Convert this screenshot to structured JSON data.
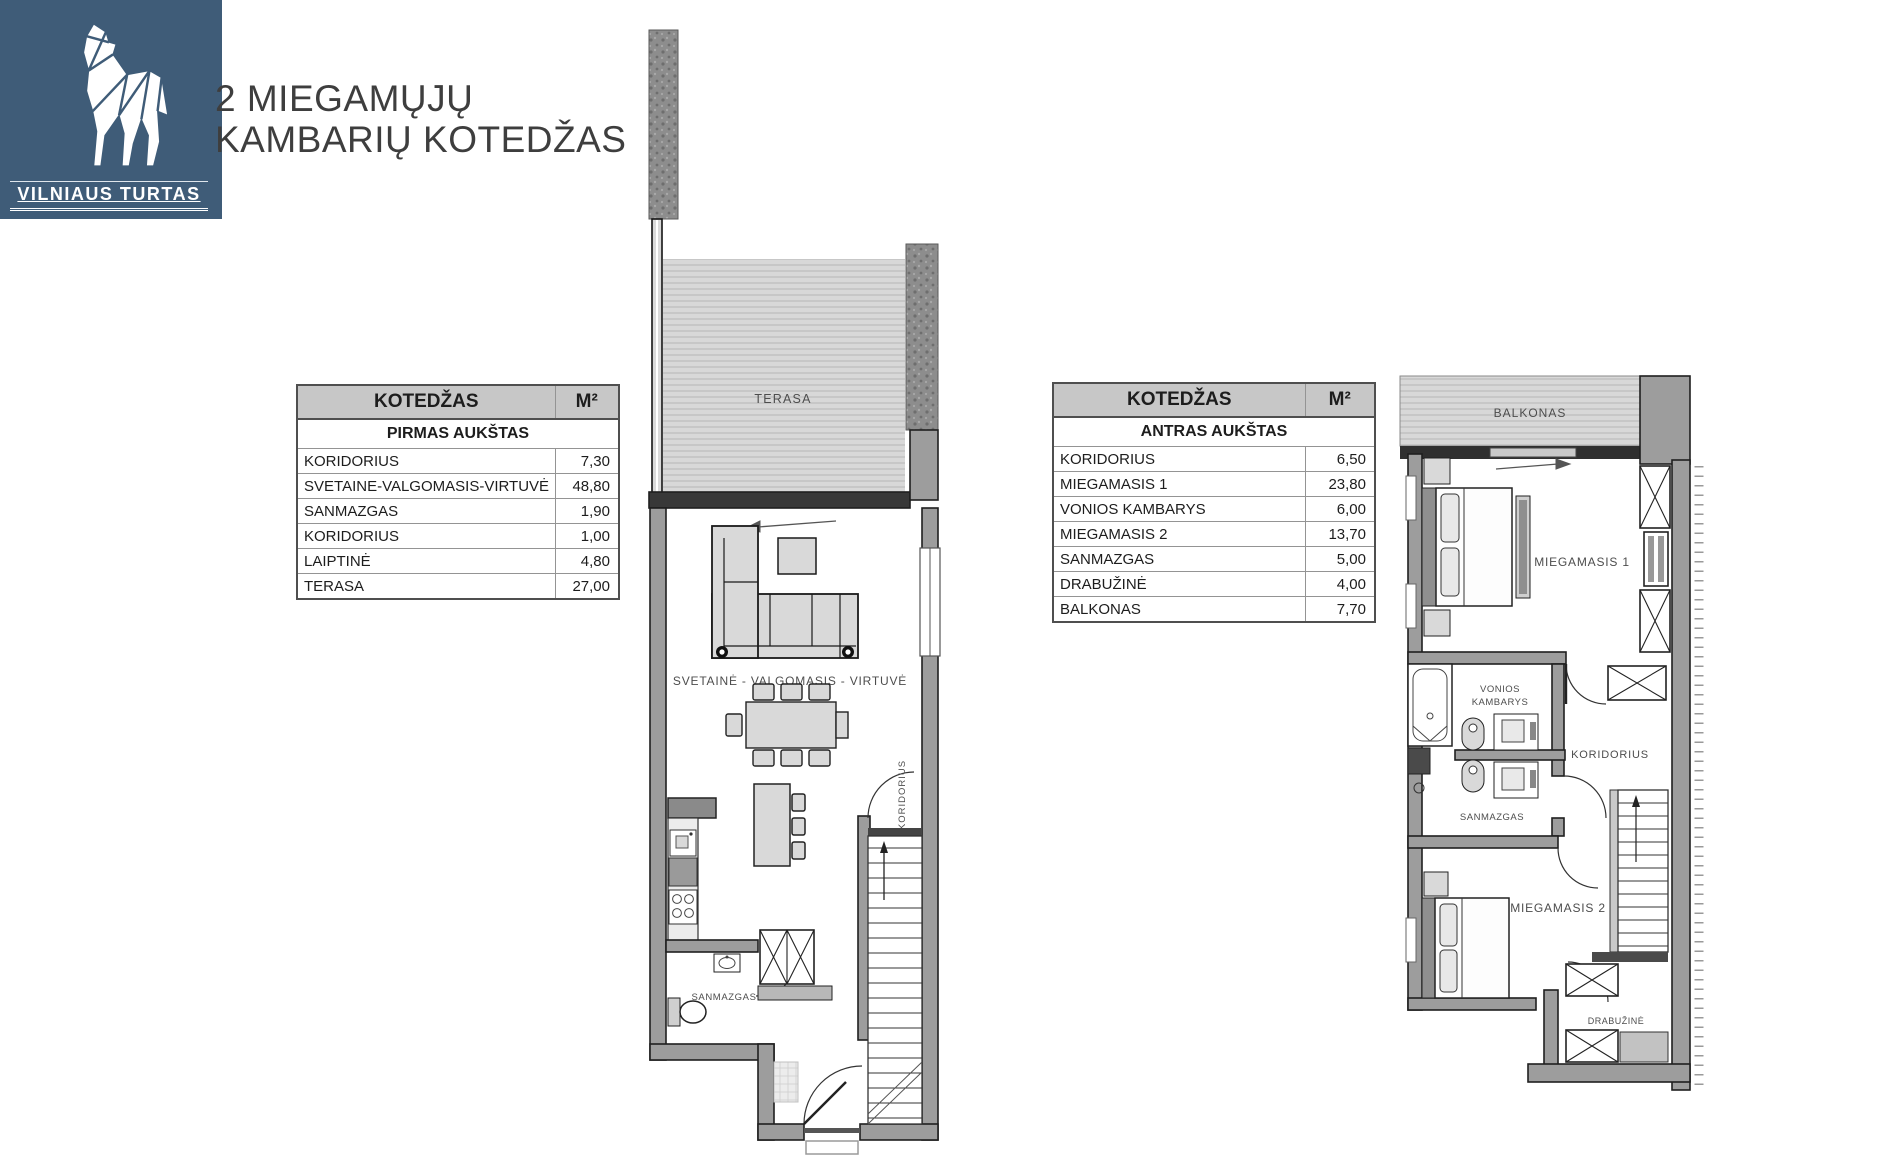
{
  "logo": {
    "brand": "VILNIAUS TURTAS"
  },
  "title": {
    "line1": "2 MIEGAMŲJŲ",
    "line2": "KAMBARIŲ KOTEDŽAS"
  },
  "tables": [
    {
      "header": "KOTEDŽAS",
      "unit_header": "M²",
      "floor": "PIRMAS AUKŠTAS",
      "rows": [
        {
          "label": "KORIDORIUS",
          "value": "7,30"
        },
        {
          "label": "SVETAINE-VALGOMASIS-VIRTUVĖ",
          "value": "48,80"
        },
        {
          "label": "SANMAZGAS",
          "value": "1,90"
        },
        {
          "label": "KORIDORIUS",
          "value": "1,00"
        },
        {
          "label": "LAIPTINĖ",
          "value": "4,80"
        },
        {
          "label": "TERASA",
          "value": "27,00"
        }
      ]
    },
    {
      "header": "KOTEDŽAS",
      "unit_header": "M²",
      "floor": "ANTRAS AUKŠTAS",
      "rows": [
        {
          "label": "KORIDORIUS",
          "value": "6,50"
        },
        {
          "label": "MIEGAMASIS 1",
          "value": "23,80"
        },
        {
          "label": "VONIOS KAMBARYS",
          "value": "6,00"
        },
        {
          "label": "MIEGAMASIS 2",
          "value": "13,70"
        },
        {
          "label": "SANMAZGAS",
          "value": "5,00"
        },
        {
          "label": "DRABUŽINĖ",
          "value": "4,00"
        },
        {
          "label": "BALKONAS",
          "value": "7,70"
        }
      ]
    }
  ],
  "floor1_labels": {
    "terasa": "TERASA",
    "living": "SVETAINĖ - VALGOMASIS - VIRTUVĖ",
    "koridorius": "KORIDORIUS",
    "sanmazgas": "SANMAZGAS"
  },
  "floor2_labels": {
    "balkonas": "BALKONAS",
    "miegamasis1": "MIEGAMASIS 1",
    "vonios_line1": "VONIOS",
    "vonios_line2": "KAMBARYS",
    "koridorius": "KORIDORIUS",
    "sanmazgas": "SANMAZGAS",
    "miegamasis2": "MIEGAMASIS 2",
    "drabuzine": "DRABUŽINĖ"
  },
  "colors": {
    "brand_bg": "#3f5c78",
    "wall_gray": "#9d9d9d",
    "table_header_bg": "#c7c7c7",
    "terrace_fill": "#d8d8d8",
    "title_text": "#3e3e3e"
  }
}
